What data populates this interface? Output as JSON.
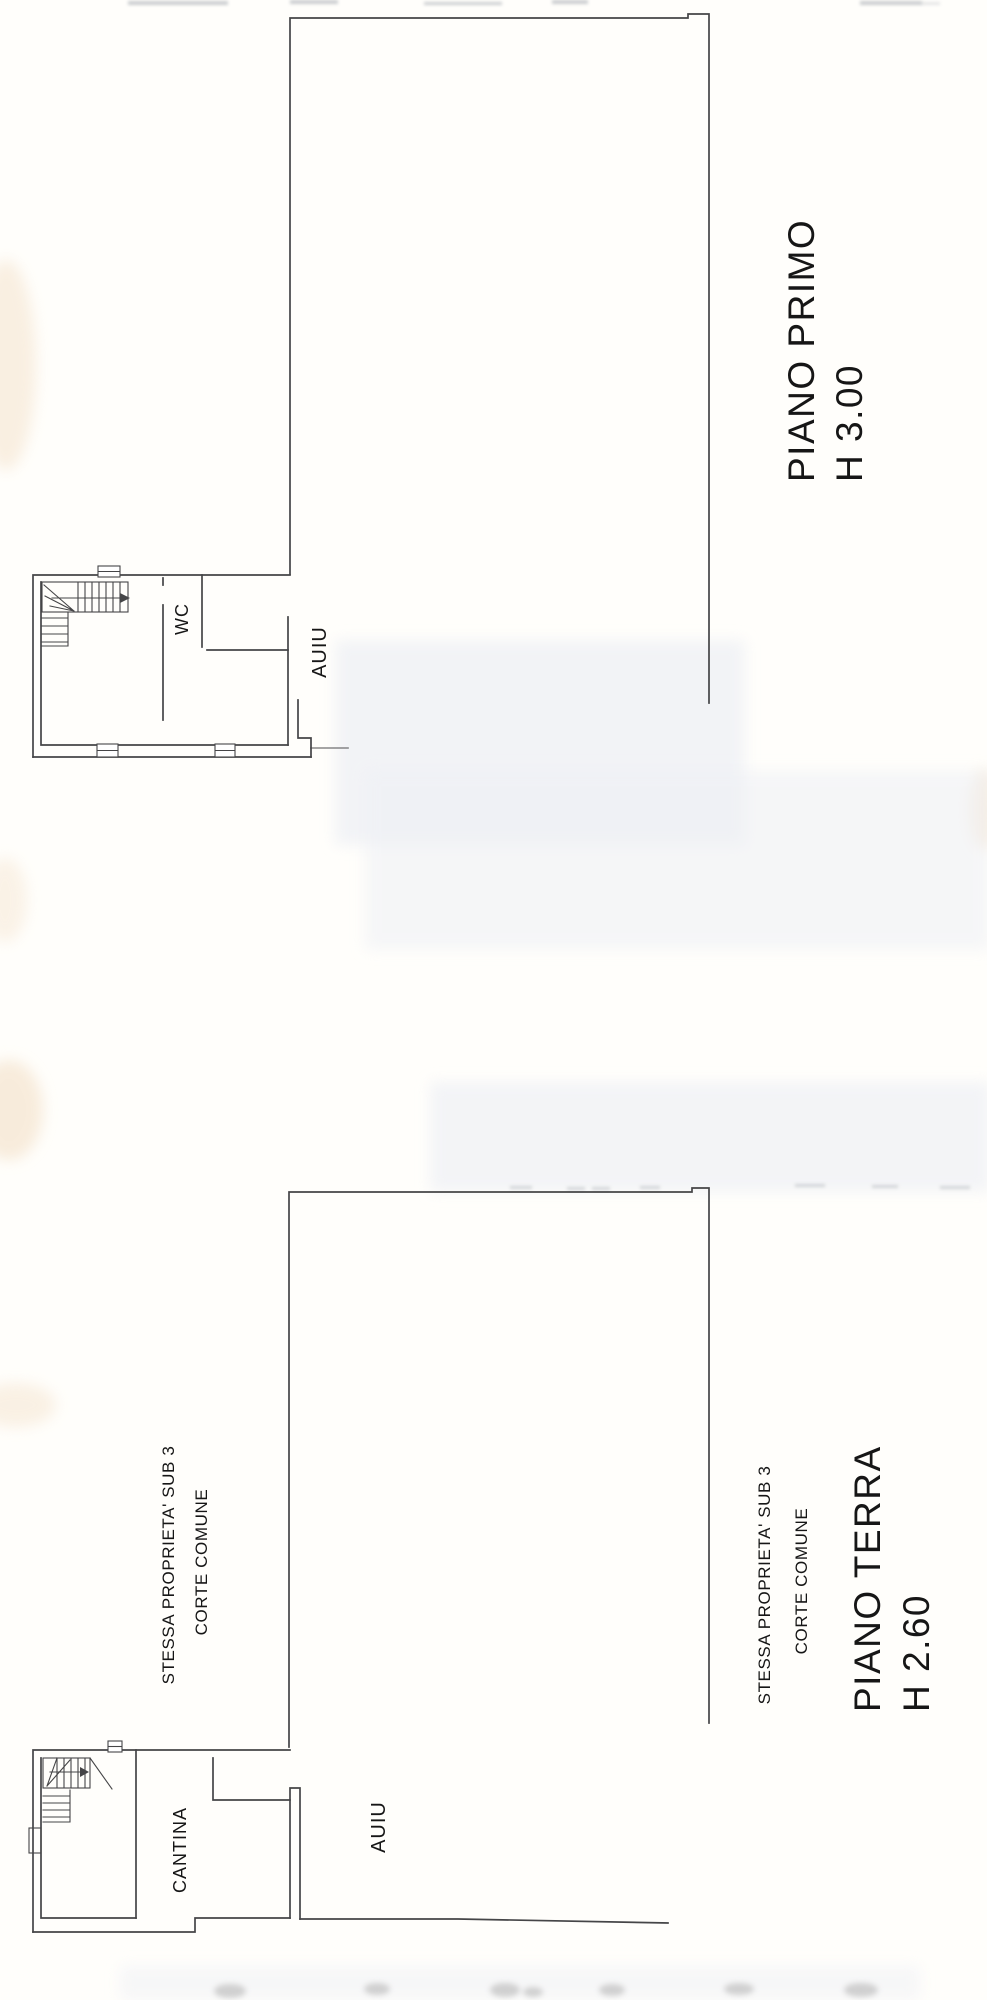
{
  "colors": {
    "background": "#fffefb",
    "line": "#454547",
    "text": "#161616",
    "stain_warm": "#f2ddc2",
    "smudge": "#eef0f5",
    "stamp": "#c9c9c9"
  },
  "floor_primo": {
    "title": "PIANO PRIMO",
    "height": "H 3.00",
    "room_wc": "WC",
    "adjacent_unit": "AUIU"
  },
  "floor_terra": {
    "title": "PIANO TERRA",
    "height": "H 2.60",
    "room_cantina": "CANTINA",
    "adjacent_unit": "AUIU",
    "note_property": "STESSA PROPRIETA' SUB 3",
    "note_court": "CORTE COMUNE",
    "note_property_2": "STESSA PROPRIETA' SUB 3",
    "note_court_2": "CORTE COMUNE"
  }
}
